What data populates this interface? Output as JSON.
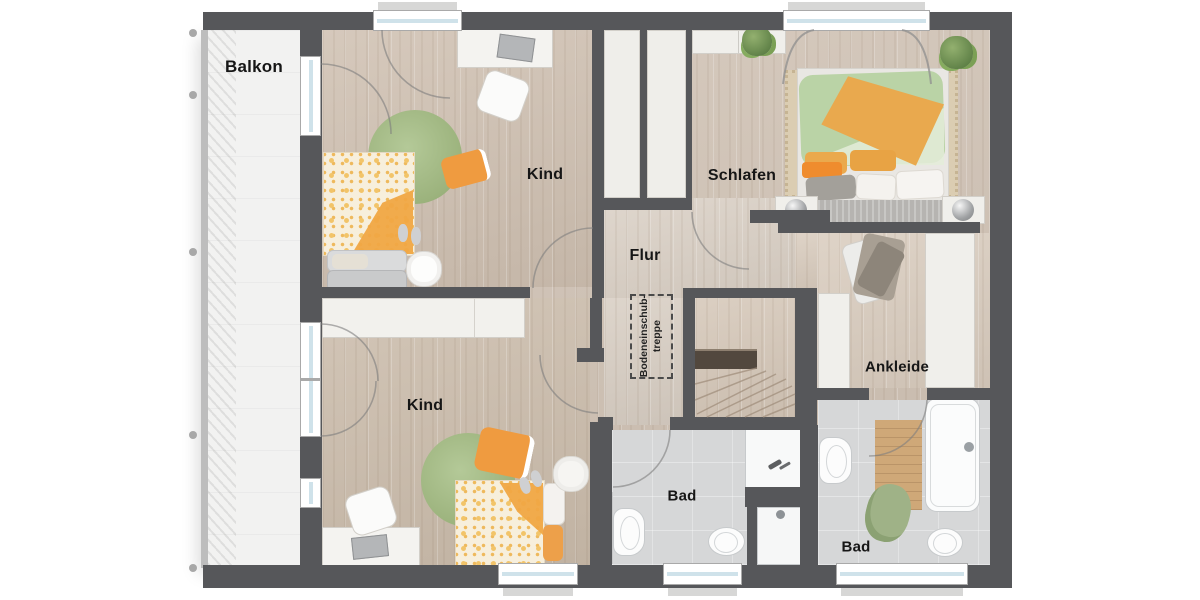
{
  "plan": {
    "rooms": {
      "balkon": {
        "label": "Balkon"
      },
      "kind_top": {
        "label": "Kind"
      },
      "schlafen": {
        "label": "Schlafen"
      },
      "flur": {
        "label": "Flur"
      },
      "kind_bottom": {
        "label": "Kind"
      },
      "bad_middle": {
        "label": "Bad"
      },
      "bad_right": {
        "label": "Bad"
      },
      "ankleide": {
        "label": "Ankleide"
      }
    },
    "stairs": {
      "label_line1": "Bodeneinschub-",
      "label_line2": "treppe"
    },
    "colors": {
      "wall": "#56575a",
      "wood_floor": "#d0c2b4",
      "hall_floor": "#dad0c5",
      "bath_floor": "#d6d7d8",
      "balcony_floor": "#f2f2f1",
      "furniture_white": "#f0efeb",
      "accent_orange": "#ee9f43",
      "rug_green": "#a9c18c",
      "duvet_green": "#b9d2a5"
    }
  }
}
